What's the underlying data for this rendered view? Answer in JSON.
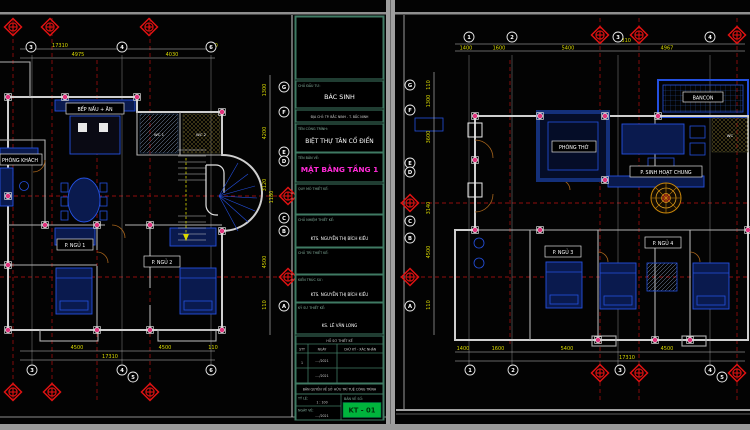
{
  "colors": {
    "background": "#030303",
    "frame_gray": "#9a9a9a",
    "grid_red": "#900d0d",
    "dimension_yellow": "#d9d900",
    "wall_gray": "#cfcfcf",
    "furniture_blue": "#2450e0",
    "column_magenta": "#e0337c",
    "title_cell_green": "#3f7a63",
    "drawing_title_magenta": "#ff2bd6",
    "sheet_number_green": "#00b43c",
    "carpet_gold": "#c8860a"
  },
  "grid_rows": [
    "G",
    "F",
    "E",
    "D",
    "C",
    "B",
    "A"
  ],
  "left_plan": {
    "cols_top": [
      "3",
      "4",
      "6"
    ],
    "cols_bottom": [
      "3",
      "4",
      "5",
      "6"
    ],
    "dims_top": [
      "17310",
      "4975",
      "4030",
      "110"
    ],
    "dims_bottom": [
      "4500",
      "4500",
      "110",
      "17310"
    ],
    "dims_side": [
      "1300",
      "4200",
      "3120",
      "1180",
      "4500",
      "110"
    ],
    "rooms": {
      "living": "PHÒNG KHÁCH",
      "kitchen": "BẾP NẤU + ĂN",
      "bed1": "P. NGỦ 1",
      "bed2": "P. NGỦ 2",
      "wc1": "WC 1",
      "wc2": "WC 2"
    }
  },
  "right_plan": {
    "cols_top": [
      "1",
      "2",
      "3",
      "4"
    ],
    "cols_bottom": [
      "1",
      "2",
      "3",
      "4",
      "5"
    ],
    "dims_top": [
      "1400",
      "1600",
      "5400",
      "4967",
      "17310"
    ],
    "dims_bottom": [
      "1400",
      "1600",
      "5400",
      "4500",
      "17310"
    ],
    "dims_side": [
      "110",
      "1300",
      "3600",
      "3140",
      "4500",
      "110"
    ],
    "rooms": {
      "balcony": "BANCON",
      "worship": "PHÒNG THỜ",
      "common": "P. SINH HOẠT CHUNG",
      "bed3": "P. NGỦ 3",
      "bed4": "P. NGỦ 4",
      "wc": "WC"
    }
  },
  "title_block": {
    "investor_label": "CHỦ ĐẦU TƯ:",
    "investor_name": "BÁC SINH",
    "address_line": "ĐỊA CHỈ: TP. BẮC NINH - T. BẮC NINH",
    "project_label": "TÊN CÔNG TRÌNH:",
    "project_name": "BIỆT THỰ TÂN CỔ ĐIỂN",
    "drawing_label": "TÊN BẢN VẼ:",
    "drawing_name": "MẶT BẰNG TẦNG 1",
    "scope_label": "QUY MÔ THIẾT KẾ:",
    "chief_label": "CHỦ NHIỆM THIẾT KẾ:",
    "chief_name": "KTS. NGUYỄN THỊ BÍCH KIỀU",
    "lead_label": "CHỦ TRÌ THIẾT KẾ:",
    "architect_label": "KIẾN TRÚC SƯ:",
    "architect_name": "KTS. NGUYỄN THỊ BÍCH KIỀU",
    "engineer_label": "KỸ SƯ THIẾT KẾ:",
    "engineer_name": "KS. LÊ VĂN LONG",
    "table_title": "HỒ SƠ THIẾT KẾ",
    "table_headers": [
      "STT",
      "NGÀY",
      "CHỮ KÝ - XÁC NHẬN"
    ],
    "table_row_index": "1",
    "table_row_date": "..../2021",
    "copyright_line": "BẢN QUYỀN VỀ SỞ HỮU TRÍ TUỆ CÔNG TRÌNH",
    "scale_label": "TỶ LỆ:",
    "scale_value": "1 : 100",
    "date_label": "NGÀY VẼ:",
    "date_value": "..../2021",
    "sheet_label": "BẢN VẼ SỐ:",
    "sheet_number": "KT - 01"
  }
}
